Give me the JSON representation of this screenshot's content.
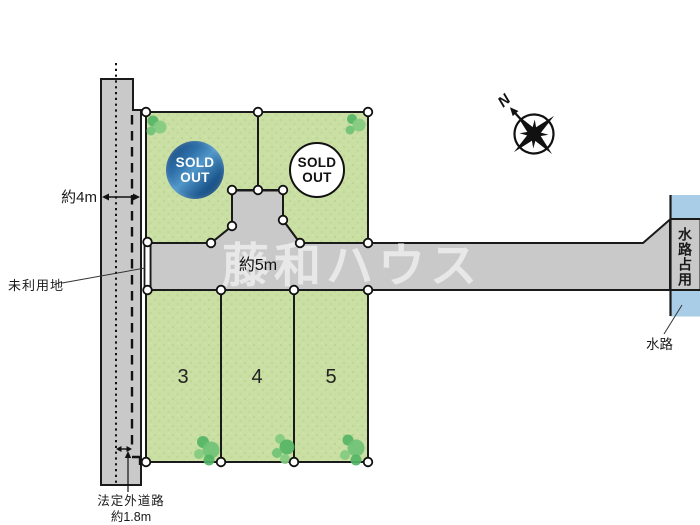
{
  "map": {
    "type": "residential-lot-plan",
    "watermark": "藤和ハウス",
    "compass_north": "N"
  },
  "labels": {
    "road_width_left": "約4m",
    "road_width_main": "約5m",
    "unused_land": "未利用地",
    "informal_road_line1": "法定外道路",
    "informal_road_line2": "約1.8m",
    "waterway_occupied": "水路占用",
    "waterway": "水路"
  },
  "plots": {
    "sold": [
      {
        "status": "SOLD OUT",
        "badge_style": "navy-circle"
      },
      {
        "status": "SOLD OUT",
        "badge_style": "white-circle"
      }
    ],
    "numbered": [
      {
        "number": "3"
      },
      {
        "number": "4"
      },
      {
        "number": "5"
      }
    ]
  },
  "colors": {
    "plot_green": "#cadfa3",
    "plot_green_dot": "#bcd592",
    "road_gray": "#c9c9c9",
    "water_blue": "#a9cde6",
    "outline": "#1a1a1a",
    "soldout_navy": "#1d588f",
    "tree_green_dark": "#54b465",
    "tree_green_light": "#83cb80"
  }
}
